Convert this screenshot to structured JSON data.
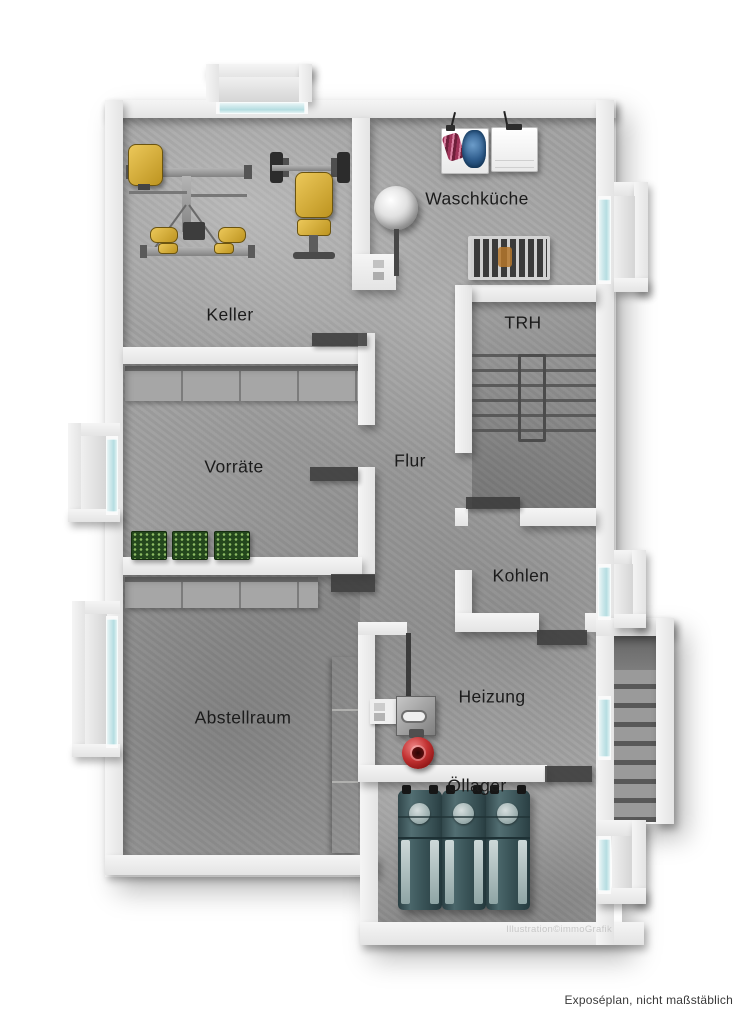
{
  "plan": {
    "rooms": {
      "keller": "Keller",
      "waschkueche": "Waschküche",
      "trh": "TRH",
      "vorraete": "Vorräte",
      "flur": "Flur",
      "kohlen": "Kohlen",
      "abstellraum": "Abstellraum",
      "heizung": "Heizung",
      "oellager": "Öllager"
    },
    "watermark": "Illustration©immoGrafik",
    "objects": {
      "gym": "multi-gym-station",
      "bench": "weight-bench-with-barbell",
      "washer_open": "washing-machine-with-laundry",
      "washer_closed": "washing-machine",
      "rack": "drying-rack",
      "round_boiler": "round-boiler",
      "crates": "bottle-crates",
      "furnace": "heating-furnace",
      "pump": "circulation-pump",
      "tanks": "oil-tanks",
      "stairs_trh": "interior-staircase",
      "stairs_ext": "exterior-staircase",
      "windows": "basement-windows"
    }
  },
  "footer": {
    "note": "Exposéplan, nicht maßstäblich"
  },
  "colors": {
    "wall": "#e4e4e4",
    "floor": "#a2a2a2",
    "glass": "#b5dde1",
    "gym_yellow": "#bd9420",
    "crate_green": "#24471d",
    "pump_red": "#c23232",
    "tank_teal": "#3a5458",
    "label": "#1b1b1b"
  }
}
